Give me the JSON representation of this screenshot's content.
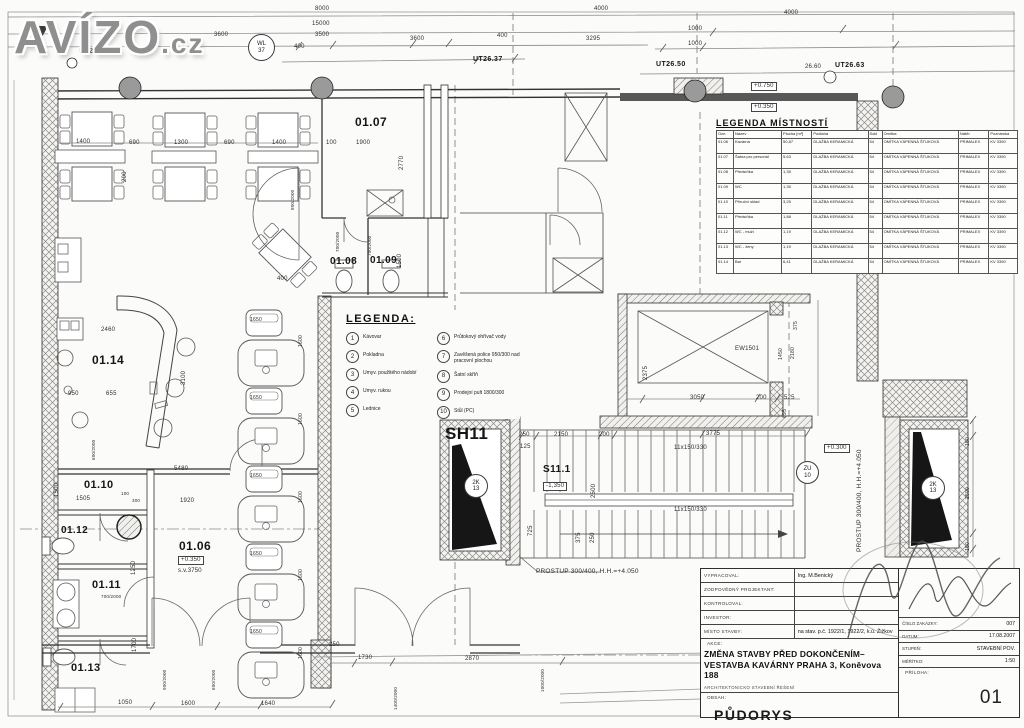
{
  "logo": {
    "main": "AVÍZO",
    "suffix": ".cz"
  },
  "colors": {
    "paper": "#fbfbf9",
    "line": "#4a4a4a",
    "logo_gray": "#8f8f8f",
    "wall_dark": "#585858",
    "black_fill": "#161616",
    "column_gray": "#9a9a9a"
  },
  "room_table": {
    "title": "LEGENDA MÍSTNOSTÍ",
    "headers": [
      "Ozn.",
      "Název",
      "Plocha [m²]",
      "Podlaha",
      "Sokl",
      "Omítka",
      "Nátěr",
      "Poznámka"
    ],
    "rows": [
      [
        "01.06",
        "Kavárna",
        "50,87",
        "DLAŽBA KERAMICKÁ",
        "54",
        "OMÍTKA VÁPENNÁ ŠTUKOVÁ",
        "PRIMALEX",
        "KV 3390"
      ],
      [
        "01.07",
        "Šatna pro personál",
        "5,63",
        "DLAŽBA KERAMICKÁ",
        "54",
        "OMÍTKA VÁPENNÁ ŠTUKOVÁ",
        "PRIMALEX",
        "KV 3390"
      ],
      [
        "01.08",
        "Předsíňka",
        "1,35",
        "DLAŽBA KERAMICKÁ",
        "54",
        "OMÍTKA VÁPENNÁ ŠTUKOVÁ",
        "PRIMALEX",
        "KV 3390"
      ],
      [
        "01.09",
        "WC",
        "1,35",
        "DLAŽBA KERAMICKÁ",
        "54",
        "OMÍTKA VÁPENNÁ ŠTUKOVÁ",
        "PRIMALEX",
        "KV 3390"
      ],
      [
        "01.10",
        "Příruční sklad",
        "3,25",
        "DLAŽBA KERAMICKÁ",
        "54",
        "OMÍTKA VÁPENNÁ ŠTUKOVÁ",
        "PRIMALEX",
        "KV 3390"
      ],
      [
        "01.11",
        "Předsíňka",
        "1,88",
        "DLAŽBA KERAMICKÁ",
        "54",
        "OMÍTKA VÁPENNÁ ŠTUKOVÁ",
        "PRIMALEX",
        "KV 3390"
      ],
      [
        "01.12",
        "WC - muži",
        "1,19",
        "DLAŽBA KERAMICKÁ",
        "54",
        "OMÍTKA VÁPENNÁ ŠTUKOVÁ",
        "PRIMALEX",
        "KV 3390"
      ],
      [
        "01.13",
        "WC - ženy",
        "1,19",
        "DLAŽBA KERAMICKÁ",
        "54",
        "OMÍTKA VÁPENNÁ ŠTUKOVÁ",
        "PRIMALEX",
        "KV 3390"
      ],
      [
        "01.14",
        "Bar",
        "6,41",
        "DLAŽBA KERAMICKÁ",
        "54",
        "OMÍTKA VÁPENNÁ ŠTUKOVÁ",
        "PRIMALEX",
        "KV 3390"
      ]
    ]
  },
  "legend": {
    "title": "LEGENDA:",
    "items": [
      {
        "n": "1",
        "t": "Kávovar"
      },
      {
        "n": "2",
        "t": "Pokladna"
      },
      {
        "n": "3",
        "t": "Umyv. použitého nádobí"
      },
      {
        "n": "4",
        "t": "Umyv. rukou"
      },
      {
        "n": "5",
        "t": "Lednice"
      },
      {
        "n": "6",
        "t": "Průtokový ohřívač vody"
      },
      {
        "n": "7",
        "t": "Zavěšená police 950/300 nad pracovní plochou"
      },
      {
        "n": "8",
        "t": "Šatní skříň"
      },
      {
        "n": "9",
        "t": "Prodejní pult 1800/300"
      },
      {
        "n": "10",
        "t": "Stůl (PC)"
      }
    ]
  },
  "title_block": {
    "rows": [
      {
        "label": "VYPRACOVAL:",
        "value": "Ing. M.Benický"
      },
      {
        "label": "ZODPOVĚDNÝ PROJEKTANT:",
        "value": ""
      },
      {
        "label": "KONTROLOVAL:",
        "value": ""
      },
      {
        "label": "INVESTOR:",
        "value": ""
      },
      {
        "label": "MÍSTO STAVBY:",
        "value": "na stav. p.č. 1922/1, 1922/2, k.ú. Žižkov"
      }
    ],
    "akce_label": "AKCE:",
    "akce_text": "ZMĚNA STAVBY PŘED DOKONČENÍM–VESTAVBA KAVÁRNY PRAHA 3, Koněvova 188",
    "akce_sub": "ARCHITEKTONICKO STAVEBNÍ ŘEŠENÍ",
    "obsah_label": "OBSAH:",
    "obsah": "PŮDORYS",
    "right_rows": [
      {
        "label": "ČÍSLO ZAKÁZKY:",
        "value": "007"
      },
      {
        "label": "DATUM:",
        "value": "17.08.2007"
      },
      {
        "label": "STUPEŇ:",
        "value": "STAVEBNÍ POV."
      },
      {
        "label": "MĚŘÍTKO:",
        "value": "1:50"
      }
    ],
    "priloha_label": "PŘÍLOHA:",
    "priloha": "01"
  },
  "badges": [
    {
      "l1": "WL",
      "l2": "37",
      "x": 248,
      "y": 34,
      "d": 25
    },
    {
      "l1": "2K",
      "l2": "13",
      "x": 464,
      "y": 474,
      "d": 22
    },
    {
      "l1": "ZU",
      "l2": "10",
      "x": 796,
      "y": 461,
      "d": 21
    },
    {
      "l1": "2K",
      "l2": "13",
      "x": 921,
      "y": 476,
      "d": 22
    }
  ],
  "labels": [
    {
      "t": "8000",
      "x": 315,
      "y": 6
    },
    {
      "t": "15000",
      "x": 312,
      "y": 21
    },
    {
      "t": "3500",
      "x": 315,
      "y": 32
    },
    {
      "t": "400",
      "x": 294,
      "y": 44
    },
    {
      "t": "3600",
      "x": 410,
      "y": 36
    },
    {
      "t": "400",
      "x": 497,
      "y": 33
    },
    {
      "t": "UT26.37",
      "x": 473,
      "y": 56,
      "b": 1,
      "s": 7
    },
    {
      "t": "4000",
      "x": 594,
      "y": 6
    },
    {
      "t": "3295",
      "x": 586,
      "y": 36
    },
    {
      "t": "4000",
      "x": 784,
      "y": 10
    },
    {
      "t": "1000",
      "x": 688,
      "y": 26
    },
    {
      "t": "1000",
      "x": 688,
      "y": 41
    },
    {
      "t": "UT26.50",
      "x": 656,
      "y": 61,
      "b": 1,
      "s": 7
    },
    {
      "t": "26.60",
      "x": 805,
      "y": 64
    },
    {
      "t": "UT26.63",
      "x": 835,
      "y": 62,
      "b": 1,
      "s": 7
    },
    {
      "t": "+0.750",
      "x": 751,
      "y": 82,
      "box": 1
    },
    {
      "t": "+0.350",
      "x": 751,
      "y": 103,
      "box": 1
    },
    {
      "t": "UT26.11",
      "x": 79,
      "y": 48,
      "b": 1,
      "s": 7
    },
    {
      "t": "3600",
      "x": 214,
      "y": 32
    },
    {
      "t": "1400",
      "x": 76,
      "y": 139
    },
    {
      "t": "690",
      "x": 129,
      "y": 140
    },
    {
      "t": "1300",
      "x": 174,
      "y": 140
    },
    {
      "t": "690",
      "x": 224,
      "y": 140
    },
    {
      "t": "1400",
      "x": 272,
      "y": 140
    },
    {
      "t": "200",
      "x": 122,
      "y": 182,
      "r": 1
    },
    {
      "t": "800/2000",
      "x": 291,
      "y": 210,
      "r": 1,
      "s": 4.5
    },
    {
      "t": "400",
      "x": 277,
      "y": 276
    },
    {
      "t": "01.07",
      "x": 355,
      "y": 116,
      "s": 12,
      "b": 1
    },
    {
      "t": "100",
      "x": 326,
      "y": 140
    },
    {
      "t": "1900",
      "x": 356,
      "y": 140
    },
    {
      "t": "2770",
      "x": 399,
      "y": 170,
      "r": 1
    },
    {
      "t": "01.08",
      "x": 330,
      "y": 257,
      "s": 10,
      "b": 1
    },
    {
      "t": "01.09",
      "x": 370,
      "y": 256,
      "s": 10,
      "b": 1
    },
    {
      "t": "700/2000",
      "x": 336,
      "y": 252,
      "r": 1,
      "s": 4.5
    },
    {
      "t": "700/2000",
      "x": 368,
      "y": 256,
      "r": 1,
      "s": 4.5
    },
    {
      "t": "1500",
      "x": 397,
      "y": 268,
      "r": 1
    },
    {
      "t": "01.14",
      "x": 92,
      "y": 354,
      "s": 12,
      "b": 1
    },
    {
      "t": "2460",
      "x": 101,
      "y": 327
    },
    {
      "t": "3100",
      "x": 181,
      "y": 385,
      "r": 1
    },
    {
      "t": "655",
      "x": 106,
      "y": 391
    },
    {
      "t": "950",
      "x": 68,
      "y": 391
    },
    {
      "t": "600/2000",
      "x": 92,
      "y": 460,
      "r": 1,
      "s": 4.5
    },
    {
      "t": "5480",
      "x": 174,
      "y": 466
    },
    {
      "t": "01.10",
      "x": 84,
      "y": 480,
      "s": 11,
      "b": 1
    },
    {
      "t": "1505",
      "x": 76,
      "y": 496
    },
    {
      "t": "1500",
      "x": 54,
      "y": 497,
      "r": 1
    },
    {
      "t": "1920",
      "x": 180,
      "y": 498
    },
    {
      "t": "100",
      "x": 121,
      "y": 492,
      "s": 4.5
    },
    {
      "t": "300",
      "x": 132,
      "y": 499,
      "s": 4.5
    },
    {
      "t": "01.12",
      "x": 61,
      "y": 526,
      "s": 10,
      "b": 1
    },
    {
      "t": "01.11",
      "x": 92,
      "y": 580,
      "s": 11,
      "b": 1
    },
    {
      "t": "700/2000",
      "x": 101,
      "y": 595,
      "s": 4.5
    },
    {
      "t": "01.13",
      "x": 71,
      "y": 663,
      "s": 11,
      "b": 1
    },
    {
      "t": "1250",
      "x": 131,
      "y": 575,
      "r": 1
    },
    {
      "t": "1700",
      "x": 132,
      "y": 652,
      "r": 1
    },
    {
      "t": "01.06",
      "x": 179,
      "y": 540,
      "s": 12,
      "b": 1
    },
    {
      "t": "+0.350",
      "x": 178,
      "y": 556,
      "box": 1
    },
    {
      "t": "s.v.3750",
      "x": 178,
      "y": 568
    },
    {
      "t": "1050",
      "x": 118,
      "y": 700
    },
    {
      "t": "1600",
      "x": 181,
      "y": 701
    },
    {
      "t": "1640",
      "x": 261,
      "y": 701
    },
    {
      "t": "900/2000",
      "x": 163,
      "y": 690,
      "r": 1,
      "s": 4.5
    },
    {
      "t": "600/2000",
      "x": 212,
      "y": 690,
      "r": 1,
      "s": 4.5
    },
    {
      "t": "250",
      "x": 329,
      "y": 642
    },
    {
      "t": "1730",
      "x": 358,
      "y": 655
    },
    {
      "t": "2870",
      "x": 465,
      "y": 656
    },
    {
      "t": "1400/2000",
      "x": 394,
      "y": 710,
      "r": 1,
      "s": 4.5
    },
    {
      "t": "1000/2000",
      "x": 541,
      "y": 692,
      "r": 1,
      "s": 4.5
    },
    {
      "t": "1650",
      "x": 250,
      "y": 318,
      "s": 5
    },
    {
      "t": "1650",
      "x": 250,
      "y": 396,
      "s": 5
    },
    {
      "t": "1650",
      "x": 250,
      "y": 474,
      "s": 5
    },
    {
      "t": "1650",
      "x": 250,
      "y": 552,
      "s": 5
    },
    {
      "t": "1650",
      "x": 250,
      "y": 630,
      "s": 5
    },
    {
      "t": "1600",
      "x": 299,
      "y": 347,
      "r": 1,
      "s": 5
    },
    {
      "t": "1600",
      "x": 299,
      "y": 425,
      "r": 1,
      "s": 5
    },
    {
      "t": "1600",
      "x": 299,
      "y": 503,
      "r": 1,
      "s": 5
    },
    {
      "t": "1600",
      "x": 299,
      "y": 581,
      "r": 1,
      "s": 5
    },
    {
      "t": "1600",
      "x": 299,
      "y": 659,
      "r": 1,
      "s": 5
    },
    {
      "t": "SH11",
      "x": 445,
      "y": 425,
      "s": 17,
      "b": 1
    },
    {
      "t": "S11.1",
      "x": 543,
      "y": 465,
      "s": 10,
      "b": 1
    },
    {
      "t": "-1,350",
      "x": 543,
      "y": 482,
      "box": 1
    },
    {
      "t": "250",
      "x": 519,
      "y": 432
    },
    {
      "t": "2150",
      "x": 554,
      "y": 432
    },
    {
      "t": "200",
      "x": 599,
      "y": 432
    },
    {
      "t": "3775",
      "x": 706,
      "y": 431
    },
    {
      "t": "125",
      "x": 520,
      "y": 444
    },
    {
      "t": "11x150/330",
      "x": 674,
      "y": 445,
      "s": 6
    },
    {
      "t": "11x150/330",
      "x": 674,
      "y": 507,
      "s": 6
    },
    {
      "t": "2500",
      "x": 591,
      "y": 498,
      "r": 1
    },
    {
      "t": "725",
      "x": 528,
      "y": 536,
      "r": 1
    },
    {
      "t": "375",
      "x": 576,
      "y": 543,
      "r": 1
    },
    {
      "t": "250",
      "x": 590,
      "y": 543,
      "r": 1
    },
    {
      "t": "PROSTUP 300/400,  H.H.=+4.050",
      "x": 536,
      "y": 569,
      "s": 6.5
    },
    {
      "t": "+0.300",
      "x": 824,
      "y": 444,
      "box": 1
    },
    {
      "t": "PROSTUP 300/400, H.H.=+4.050",
      "x": 857,
      "y": 552,
      "r": 1,
      "s": 6.5
    },
    {
      "t": "EW1501",
      "x": 735,
      "y": 346,
      "s": 6
    },
    {
      "t": "2375",
      "x": 643,
      "y": 380,
      "r": 1
    },
    {
      "t": "3050",
      "x": 690,
      "y": 395
    },
    {
      "t": "200",
      "x": 756,
      "y": 395
    },
    {
      "t": "525",
      "x": 784,
      "y": 395
    },
    {
      "t": "695",
      "x": 783,
      "y": 418,
      "r": 1,
      "s": 5
    },
    {
      "t": "1450",
      "x": 779,
      "y": 360,
      "r": 1,
      "s": 5
    },
    {
      "t": "2180",
      "x": 791,
      "y": 359,
      "r": 1,
      "s": 5
    },
    {
      "t": "375",
      "x": 794,
      "y": 330,
      "r": 1,
      "s": 5
    },
    {
      "t": "150",
      "x": 966,
      "y": 446,
      "r": 1,
      "s": 5
    },
    {
      "t": "2500",
      "x": 966,
      "y": 499,
      "r": 1,
      "s": 5
    },
    {
      "t": "150",
      "x": 966,
      "y": 551,
      "r": 1,
      "s": 5
    }
  ]
}
